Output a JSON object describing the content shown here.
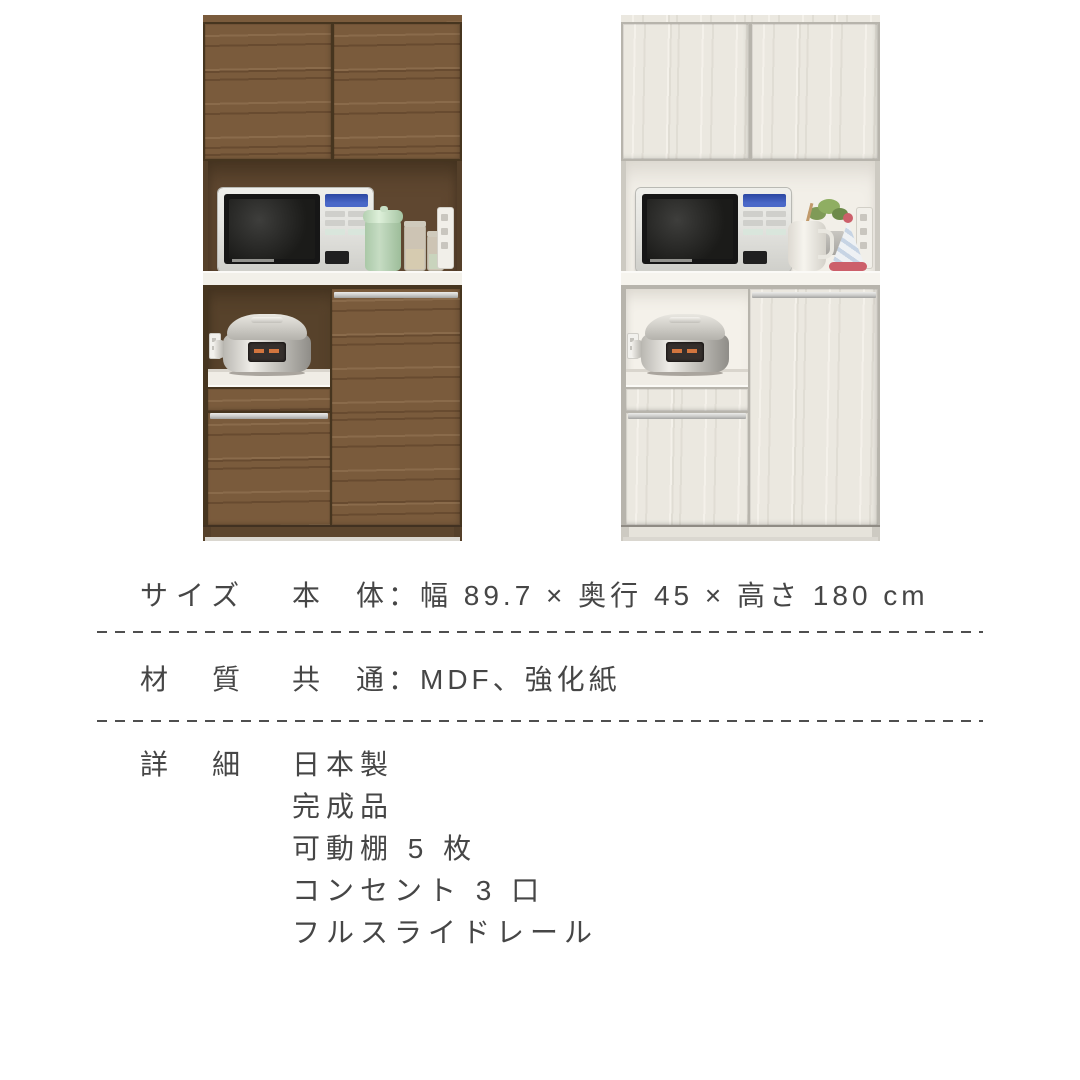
{
  "page": {
    "background": "#ffffff"
  },
  "products": [
    {
      "id": "kitchen-board-brown",
      "variant": "walnut-brown",
      "palette": {
        "door": "#7a5b3c",
        "grainA": "#8a6b4b",
        "grainB": "#684b30",
        "edge": "#55402a",
        "gap": "#46351f",
        "interior": "#5f4730",
        "interiorShadow": "#43321f",
        "niche": "#57422b",
        "counter": "#f2f0e9",
        "kick": "#5d462e",
        "handle": "#c9c9c7"
      }
    },
    {
      "id": "kitchen-board-white",
      "variant": "white-wood",
      "palette": {
        "door": "#ebe8e0",
        "grainA": "#f4f1ea",
        "grainB": "#e0ddd4",
        "edge": "#cdcac2",
        "gap": "#b7b4ac",
        "interior": "#f2efe8",
        "interiorShadow": "#dad6ce",
        "niche": "#f4f1ea",
        "counter": "#f6f4ee",
        "kick": "#e6e3db",
        "handle": "#cbcbc9"
      }
    }
  ],
  "props_palette": {
    "applianceBody": "#e4e4e0",
    "applianceDoor": "#161616",
    "displayBlue": "#4a68c8",
    "cookerSilver": "#c9c7c1",
    "cookerWindow": "#352f2c",
    "cookerDigits": "#d2753e",
    "canisterMint": "#c6dcc3",
    "jarGlass": "#dcd5c4",
    "plantGreen": "#7f9a57",
    "coneRed": "#cc5f6a",
    "pitcherWhite": "#f6f4ee"
  },
  "specs": {
    "size_label": "サイズ",
    "size_value": "本　体：幅 89.7 × 奥行 45 × 高さ 180 cm",
    "material_label": "材　質",
    "material_value": "共　通：MDF、強化紙",
    "detail_label": "詳　細",
    "details": [
      "日本製",
      "完成品",
      "可動棚 5 枚",
      "コンセント 3 口",
      "フルスライドレール"
    ]
  }
}
